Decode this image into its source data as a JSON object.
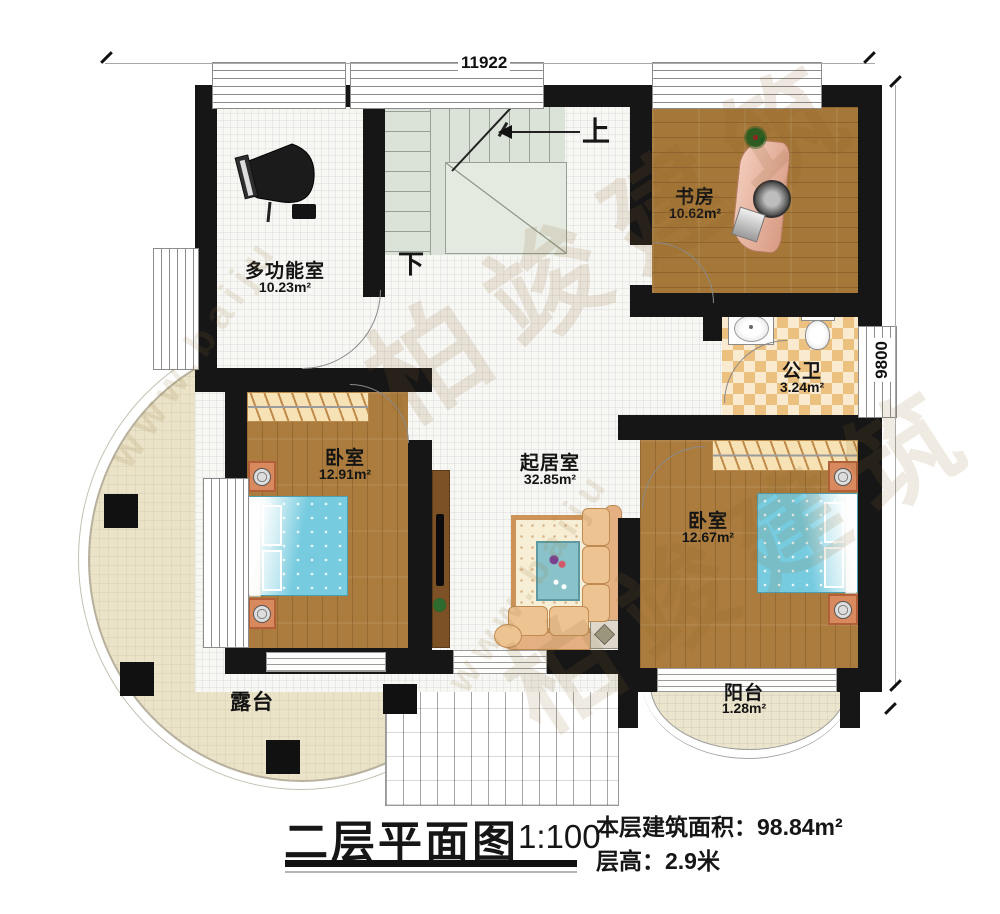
{
  "dimensions": {
    "top": "11922",
    "right": "9800"
  },
  "stairs": {
    "up": "上",
    "down": "下"
  },
  "rooms": {
    "multi": {
      "name": "多功能室",
      "area": "10.23m²"
    },
    "study": {
      "name": "书房",
      "area": "10.62m²"
    },
    "bath": {
      "name": "公卫",
      "area": "3.24m²"
    },
    "bedroom_left": {
      "name": "卧室",
      "area": "12.91m²"
    },
    "living": {
      "name": "起居室",
      "area": "32.85m²"
    },
    "bedroom_right": {
      "name": "卧室",
      "area": "12.67m²"
    },
    "terrace": {
      "name": "露台"
    },
    "balcony": {
      "name": "阳台",
      "area": "1.28m²"
    }
  },
  "title_block": {
    "title": "二层平面图",
    "scale": "1:100",
    "stats": [
      {
        "label": "本层建筑面积：",
        "value": "98.84m²"
      },
      {
        "label": "层高：",
        "value": "2.9米"
      }
    ]
  },
  "watermark": {
    "brand": "柏竣建筑",
    "url": "www.baiju"
  },
  "colors": {
    "wall": "#161616",
    "wood": "#a87a3b",
    "tile": "#ecc07e",
    "bed": "#76cbdf",
    "terrace": "#ebe3c8"
  }
}
